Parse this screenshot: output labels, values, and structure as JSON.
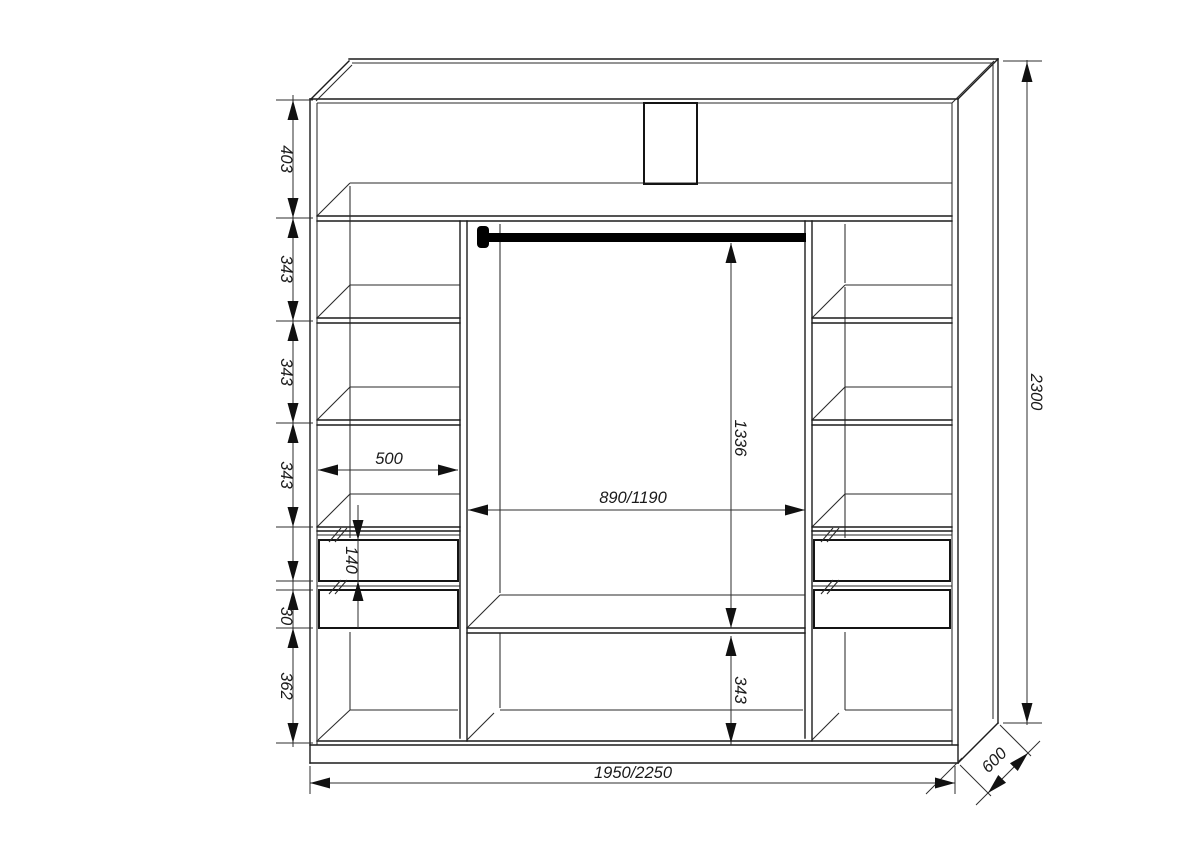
{
  "dims": {
    "top_section_height": "403",
    "shelf_section_heights": [
      "343",
      "343",
      "343"
    ],
    "drawer_front_height": "140",
    "drawer_gap": "30",
    "bottom_left_height": "362",
    "left_column_width": "500",
    "center_width": "890/1190",
    "rod_to_shelf_height": "1336",
    "bottom_center_height": "343",
    "overall_height": "2300",
    "overall_width": "1950/2250",
    "overall_depth": "600"
  },
  "colors": {
    "line": "#1c1c1c",
    "dimension_line": "#2e2e2e",
    "rod": "#000000",
    "background": "#ffffff"
  }
}
